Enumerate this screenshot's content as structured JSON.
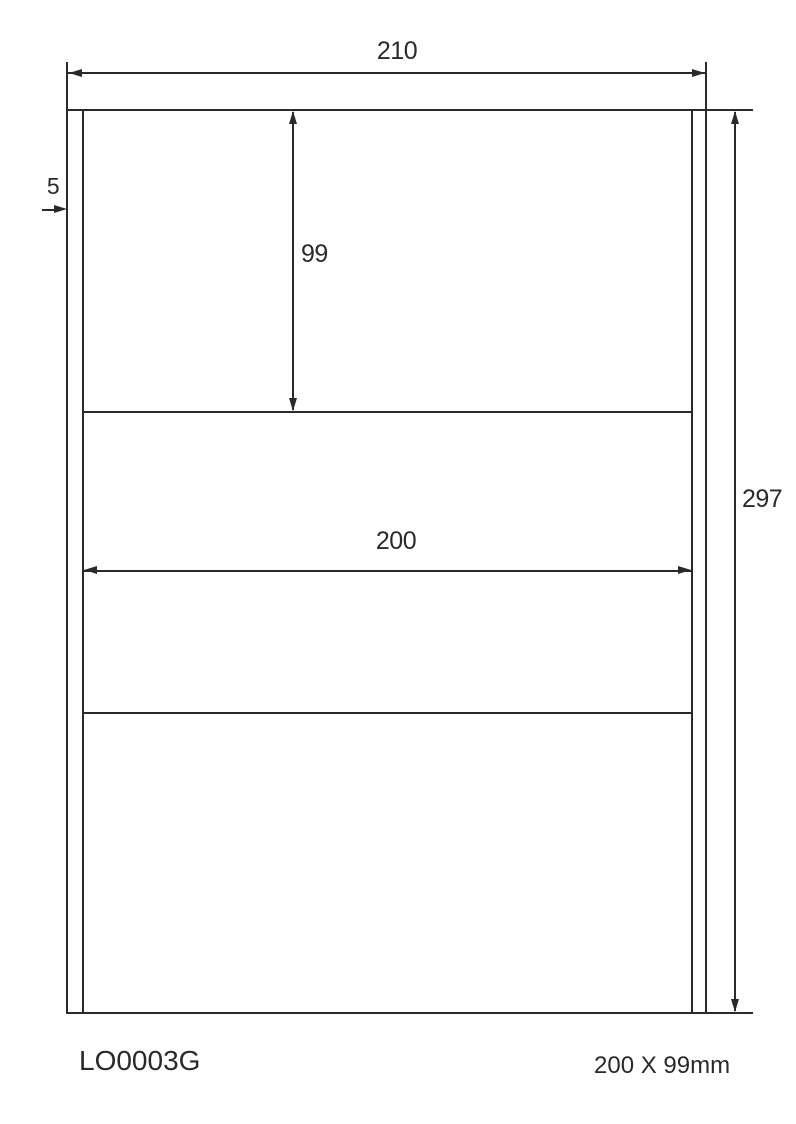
{
  "colors": {
    "line": "#2b2a29",
    "background": "#ffffff"
  },
  "diagram": {
    "type": "label-sheet-dimension-drawing",
    "dimensions": {
      "page_width": "210",
      "page_height": "297",
      "label_height": "99",
      "label_width": "200",
      "side_margin": "5"
    }
  },
  "footer": {
    "product_code": "LO0003G",
    "label_size": "200 X 99mm"
  }
}
